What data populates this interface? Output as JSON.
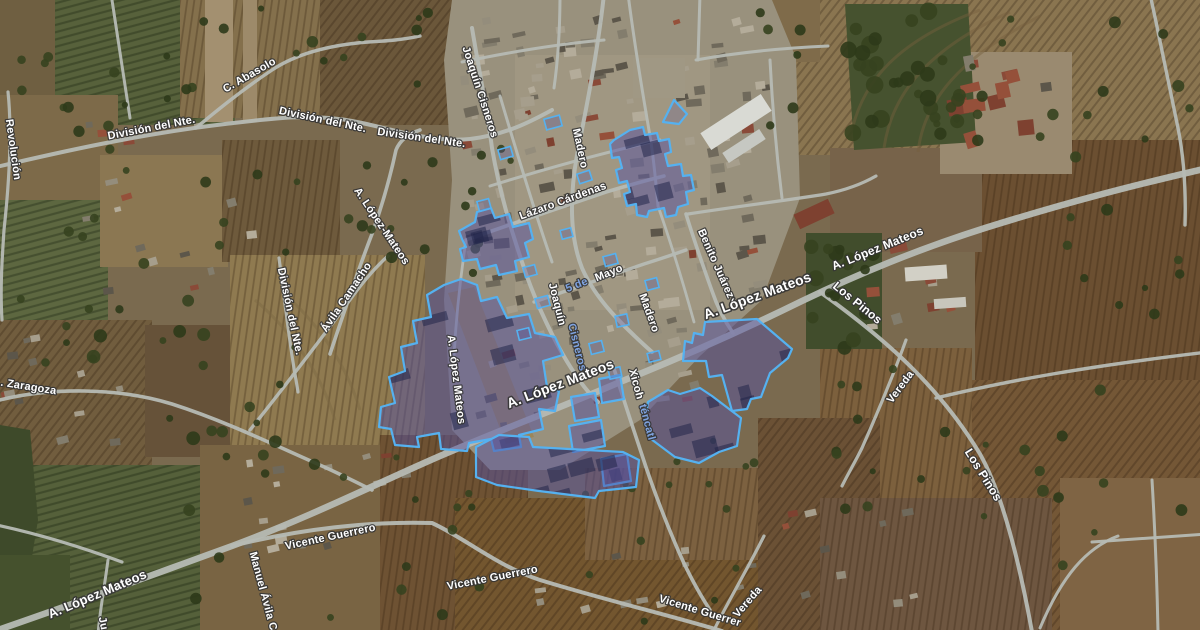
{
  "map": {
    "kind": "satellite-map",
    "overlay": {
      "fill": "#55519f",
      "fill_opacity": 0.5,
      "stroke": "#55b1f0",
      "stroke_width": 2.2,
      "tinted_label_color": "#7fa3e0",
      "label_color": "#ffffff",
      "label_halo": "#343434"
    },
    "labels": [
      {
        "t": "Revolución",
        "x": 10,
        "y": 150,
        "r": 82,
        "s": 11
      },
      {
        "t": "C. Abasolo",
        "x": 251,
        "y": 78,
        "r": -30,
        "s": 11
      },
      {
        "t": "División del Nte.",
        "x": 152,
        "y": 131,
        "r": -11,
        "s": 11
      },
      {
        "t": "División del Nte.",
        "x": 322,
        "y": 123,
        "r": 12,
        "s": 11
      },
      {
        "t": "División del Nte.",
        "x": 421,
        "y": 141,
        "r": 8,
        "s": 11
      },
      {
        "t": "Joaquín Cisneros",
        "x": 477,
        "y": 93,
        "r": 72,
        "s": 11
      },
      {
        "t": "Madero",
        "x": 577,
        "y": 149,
        "r": 78,
        "s": 11
      },
      {
        "t": "Lázaro Cárdenas",
        "x": 564,
        "y": 204,
        "r": -20,
        "s": 11
      },
      {
        "t": "5 de",
        "x": 578,
        "y": 288,
        "r": -22,
        "s": 11,
        "c": "#7fa3e0"
      },
      {
        "t": "Mayo",
        "x": 610,
        "y": 276,
        "r": -22,
        "s": 11
      },
      {
        "t": "Joaquín",
        "x": 554,
        "y": 305,
        "r": 76,
        "s": 11
      },
      {
        "t": "Cisneros",
        "x": 574,
        "y": 348,
        "r": 76,
        "s": 11,
        "c": "#7fa3e0"
      },
      {
        "t": "Madero",
        "x": 646,
        "y": 314,
        "r": 70,
        "s": 11
      },
      {
        "t": "Benito Juárez",
        "x": 713,
        "y": 265,
        "r": 66,
        "s": 11
      },
      {
        "t": "A. López Mateos",
        "x": 759,
        "y": 300,
        "r": -20,
        "s": 14
      },
      {
        "t": "A. López Mateos",
        "x": 879,
        "y": 252,
        "r": -22,
        "s": 12
      },
      {
        "t": "Los Pinos",
        "x": 855,
        "y": 306,
        "r": 39,
        "s": 12
      },
      {
        "t": "Los Pinos",
        "x": 980,
        "y": 477,
        "r": 58,
        "s": 12
      },
      {
        "t": "Vereda",
        "x": 903,
        "y": 389,
        "r": -53,
        "s": 11
      },
      {
        "t": "Vereda",
        "x": 750,
        "y": 604,
        "r": -49,
        "s": 11
      },
      {
        "t": "Xicoh",
        "x": 633,
        "y": 385,
        "r": 75,
        "s": 11
      },
      {
        "t": "téncatl",
        "x": 644,
        "y": 423,
        "r": 75,
        "s": 11,
        "c": "#7fa3e0"
      },
      {
        "t": ". Zaragoza",
        "x": 28,
        "y": 390,
        "r": 9,
        "s": 11
      },
      {
        "t": "Ávila Camacho",
        "x": 349,
        "y": 299,
        "r": -56,
        "s": 11
      },
      {
        "t": "División del Nte.",
        "x": 287,
        "y": 312,
        "r": 78,
        "s": 11
      },
      {
        "t": "A. López-Mateos",
        "x": 379,
        "y": 228,
        "r": 56,
        "s": 11
      },
      {
        "t": "A. López Mateos",
        "x": 453,
        "y": 380,
        "r": 83,
        "s": 11
      },
      {
        "t": "A. López Mateos",
        "x": 562,
        "y": 388,
        "r": -21,
        "s": 14
      },
      {
        "t": "A. López Mateos",
        "x": 99,
        "y": 598,
        "r": -23,
        "s": 13
      },
      {
        "t": "Manuel Ávila C",
        "x": 260,
        "y": 592,
        "r": 75,
        "s": 11
      },
      {
        "t": "Ju",
        "x": 100,
        "y": 624,
        "r": 78,
        "s": 11
      },
      {
        "t": "Vicente Guerrero",
        "x": 331,
        "y": 540,
        "r": -12,
        "s": 11
      },
      {
        "t": "Vicente Guerrero",
        "x": 493,
        "y": 581,
        "r": -11,
        "s": 11
      },
      {
        "t": "Vicente Guerrer",
        "x": 699,
        "y": 614,
        "r": 17,
        "s": 11
      }
    ],
    "highlight_polygons": [
      {
        "name": "block-a",
        "points": [
          [
            614,
            140
          ],
          [
            630,
            130
          ],
          [
            643,
            127
          ],
          [
            645,
            135
          ],
          [
            657,
            133
          ],
          [
            659,
            141
          ],
          [
            669,
            139
          ],
          [
            671,
            152
          ],
          [
            665,
            154
          ],
          [
            668,
            166
          ],
          [
            681,
            164
          ],
          [
            683,
            176
          ],
          [
            691,
            175
          ],
          [
            694,
            190
          ],
          [
            686,
            192
          ],
          [
            688,
            204
          ],
          [
            678,
            207
          ],
          [
            676,
            215
          ],
          [
            666,
            217
          ],
          [
            664,
            208
          ],
          [
            649,
            211
          ],
          [
            647,
            217
          ],
          [
            637,
            215
          ],
          [
            636,
            204
          ],
          [
            627,
            206
          ],
          [
            624,
            194
          ],
          [
            630,
            192
          ],
          [
            627,
            181
          ],
          [
            619,
            183
          ],
          [
            616,
            170
          ],
          [
            622,
            168
          ],
          [
            619,
            157
          ],
          [
            612,
            158
          ],
          [
            610,
            144
          ]
        ]
      },
      {
        "name": "triangle",
        "fo": 0.22,
        "points": [
          [
            663,
            122
          ],
          [
            674,
            100
          ],
          [
            687,
            114
          ],
          [
            679,
            124
          ]
        ]
      },
      {
        "name": "block-b",
        "points": [
          [
            459,
            231
          ],
          [
            475,
            222
          ],
          [
            477,
            212
          ],
          [
            491,
            208
          ],
          [
            495,
            218
          ],
          [
            509,
            214
          ],
          [
            513,
            227
          ],
          [
            529,
            223
          ],
          [
            533,
            239
          ],
          [
            525,
            243
          ],
          [
            529,
            257
          ],
          [
            515,
            261
          ],
          [
            517,
            271
          ],
          [
            499,
            275
          ],
          [
            496,
            265
          ],
          [
            480,
            269
          ],
          [
            477,
            259
          ],
          [
            463,
            261
          ],
          [
            460,
            249
          ],
          [
            466,
            247
          ],
          [
            462,
            239
          ]
        ]
      },
      {
        "name": "block-c",
        "points": [
          [
            444,
            285
          ],
          [
            461,
            279
          ],
          [
            477,
            285
          ],
          [
            481,
            301
          ],
          [
            497,
            297
          ],
          [
            507,
            318
          ],
          [
            529,
            314
          ],
          [
            535,
            333
          ],
          [
            555,
            337
          ],
          [
            563,
            355
          ],
          [
            543,
            361
          ],
          [
            547,
            387
          ],
          [
            559,
            391
          ],
          [
            555,
            411
          ],
          [
            539,
            409
          ],
          [
            543,
            429
          ],
          [
            519,
            435
          ],
          [
            521,
            447
          ],
          [
            494,
            451
          ],
          [
            491,
            439
          ],
          [
            469,
            443
          ],
          [
            467,
            451
          ],
          [
            441,
            449
          ],
          [
            439,
            433
          ],
          [
            417,
            437
          ],
          [
            419,
            447
          ],
          [
            395,
            445
          ],
          [
            391,
            429
          ],
          [
            379,
            427
          ],
          [
            381,
            407
          ],
          [
            395,
            403
          ],
          [
            389,
            377
          ],
          [
            405,
            371
          ],
          [
            401,
            347
          ],
          [
            417,
            343
          ],
          [
            413,
            321
          ],
          [
            431,
            317
          ],
          [
            427,
            295
          ]
        ]
      },
      {
        "name": "block-d",
        "points": [
          [
            571,
            397
          ],
          [
            595,
            393
          ],
          [
            599,
            417
          ],
          [
            575,
            421
          ]
        ]
      },
      {
        "name": "block-e",
        "points": [
          [
            569,
            426
          ],
          [
            601,
            420
          ],
          [
            605,
            446
          ],
          [
            573,
            452
          ]
        ]
      },
      {
        "name": "block-f",
        "points": [
          [
            683,
            361
          ],
          [
            685,
            341
          ],
          [
            692,
            343
          ],
          [
            694,
            333
          ],
          [
            703,
            335
          ],
          [
            705,
            322
          ],
          [
            757,
            319
          ],
          [
            764,
            325
          ],
          [
            792,
            349
          ],
          [
            788,
            358
          ],
          [
            770,
            373
          ],
          [
            761,
            397
          ],
          [
            751,
            399
          ],
          [
            747,
            409
          ],
          [
            732,
            411
          ],
          [
            722,
            375
          ],
          [
            709,
            377
          ],
          [
            706,
            361
          ]
        ]
      },
      {
        "name": "block-g",
        "points": [
          [
            648,
            402
          ],
          [
            668,
            390
          ],
          [
            680,
            394
          ],
          [
            700,
            388
          ],
          [
            712,
            396
          ],
          [
            741,
            418
          ],
          [
            737,
            446
          ],
          [
            719,
            452
          ],
          [
            699,
            463
          ],
          [
            675,
            457
          ],
          [
            651,
            439
          ],
          [
            645,
            420
          ]
        ]
      },
      {
        "name": "block-h",
        "points": [
          [
            599,
            379
          ],
          [
            620,
            375
          ],
          [
            624,
            399
          ],
          [
            602,
            403
          ]
        ]
      },
      {
        "name": "block-i",
        "points": [
          [
            601,
            459
          ],
          [
            627,
            454
          ],
          [
            631,
            481
          ],
          [
            604,
            486
          ]
        ]
      },
      {
        "name": "block-j",
        "points": [
          [
            476,
            447
          ],
          [
            499,
            435
          ],
          [
            529,
            437
          ],
          [
            533,
            447
          ],
          [
            623,
            452
          ],
          [
            639,
            460
          ],
          [
            636,
            487
          ],
          [
            599,
            491
          ],
          [
            595,
            498
          ],
          [
            539,
            491
          ],
          [
            497,
            485
          ],
          [
            476,
            477
          ]
        ]
      }
    ],
    "building_outlines": [
      [
        545,
        117,
        16,
        11,
        -15
      ],
      [
        578,
        172,
        13,
        10,
        -18
      ],
      [
        499,
        148,
        13,
        10,
        -16
      ],
      [
        561,
        229,
        11,
        9,
        -15
      ],
      [
        604,
        255,
        13,
        10,
        -15
      ],
      [
        646,
        279,
        12,
        10,
        -15
      ],
      [
        616,
        315,
        12,
        11,
        -12
      ],
      [
        590,
        342,
        13,
        11,
        -14
      ],
      [
        524,
        266,
        12,
        10,
        -15
      ],
      [
        536,
        297,
        13,
        10,
        -15
      ],
      [
        518,
        329,
        12,
        10,
        -14
      ],
      [
        648,
        352,
        12,
        9,
        -14
      ],
      [
        609,
        368,
        12,
        10,
        -12
      ],
      [
        478,
        200,
        12,
        10,
        -15
      ]
    ]
  }
}
